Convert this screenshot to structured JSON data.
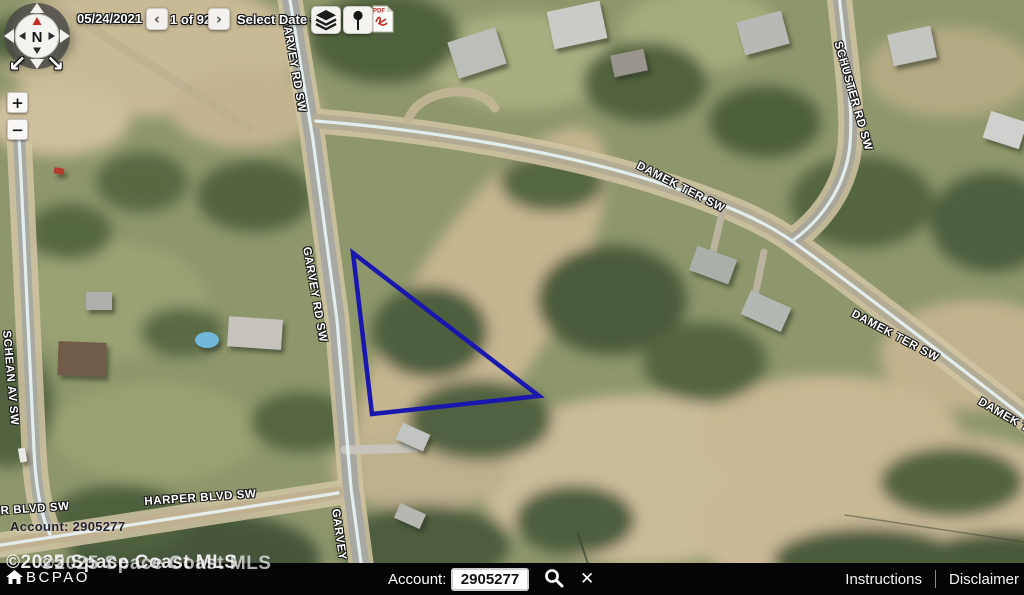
{
  "toolbar": {
    "date": "05/24/2021",
    "prev": "‹",
    "page": "1 of 92",
    "next": "›",
    "select_date": "Select Date",
    "select_caret": "▾",
    "layers_icon": "layers-stack",
    "pin_icon": "pushpin-marker",
    "pdf_label": "PDF"
  },
  "compass": {
    "north": "N",
    "rotate_left_glyph": "↙",
    "rotate_right_glyph": "↘"
  },
  "zoom_controls": {
    "zoom_in": "+",
    "zoom_out": "−"
  },
  "map": {
    "street_labels": [
      {
        "text": "GARVEY RD SW",
        "x": 291,
        "y": 16,
        "rot": 80
      },
      {
        "text": "GARVEY RD SW",
        "x": 312,
        "y": 246,
        "rot": 80
      },
      {
        "text": "GARVEY RD S",
        "x": 341,
        "y": 508,
        "rot": 82
      },
      {
        "text": "DAMEK TER SW",
        "x": 640,
        "y": 160,
        "rot": 27
      },
      {
        "text": "DAMEK TER SW",
        "x": 855,
        "y": 308,
        "rot": 28
      },
      {
        "text": "DAMEK TE",
        "x": 982,
        "y": 396,
        "rot": 30
      },
      {
        "text": "SCHUSTER RD SW",
        "x": 843,
        "y": 40,
        "rot": 74
      },
      {
        "text": "SCHEAN AV SW",
        "x": 12,
        "y": 330,
        "rot": 85
      },
      {
        "text": "HARPER BLVD SW",
        "x": 144,
        "y": 496,
        "rot": -4
      },
      {
        "text": "ER BLVD SW",
        "x": -8,
        "y": 506,
        "rot": -4
      }
    ],
    "account_overlay": "Account: 2905277",
    "watermark": "©2025 Space Coast MLS",
    "logo_text": "BCPAO",
    "logo_icon": "house-icon",
    "parcel": {
      "points": "353,253 372,414 539,396",
      "color": "#1a17ae"
    }
  },
  "statusbar": {
    "account_label": "Account:",
    "account_value": "2905277",
    "search_icon": "magnifier",
    "clear_glyph": "✕",
    "instructions": "Instructions",
    "disclaimer": "Disclaimer"
  }
}
